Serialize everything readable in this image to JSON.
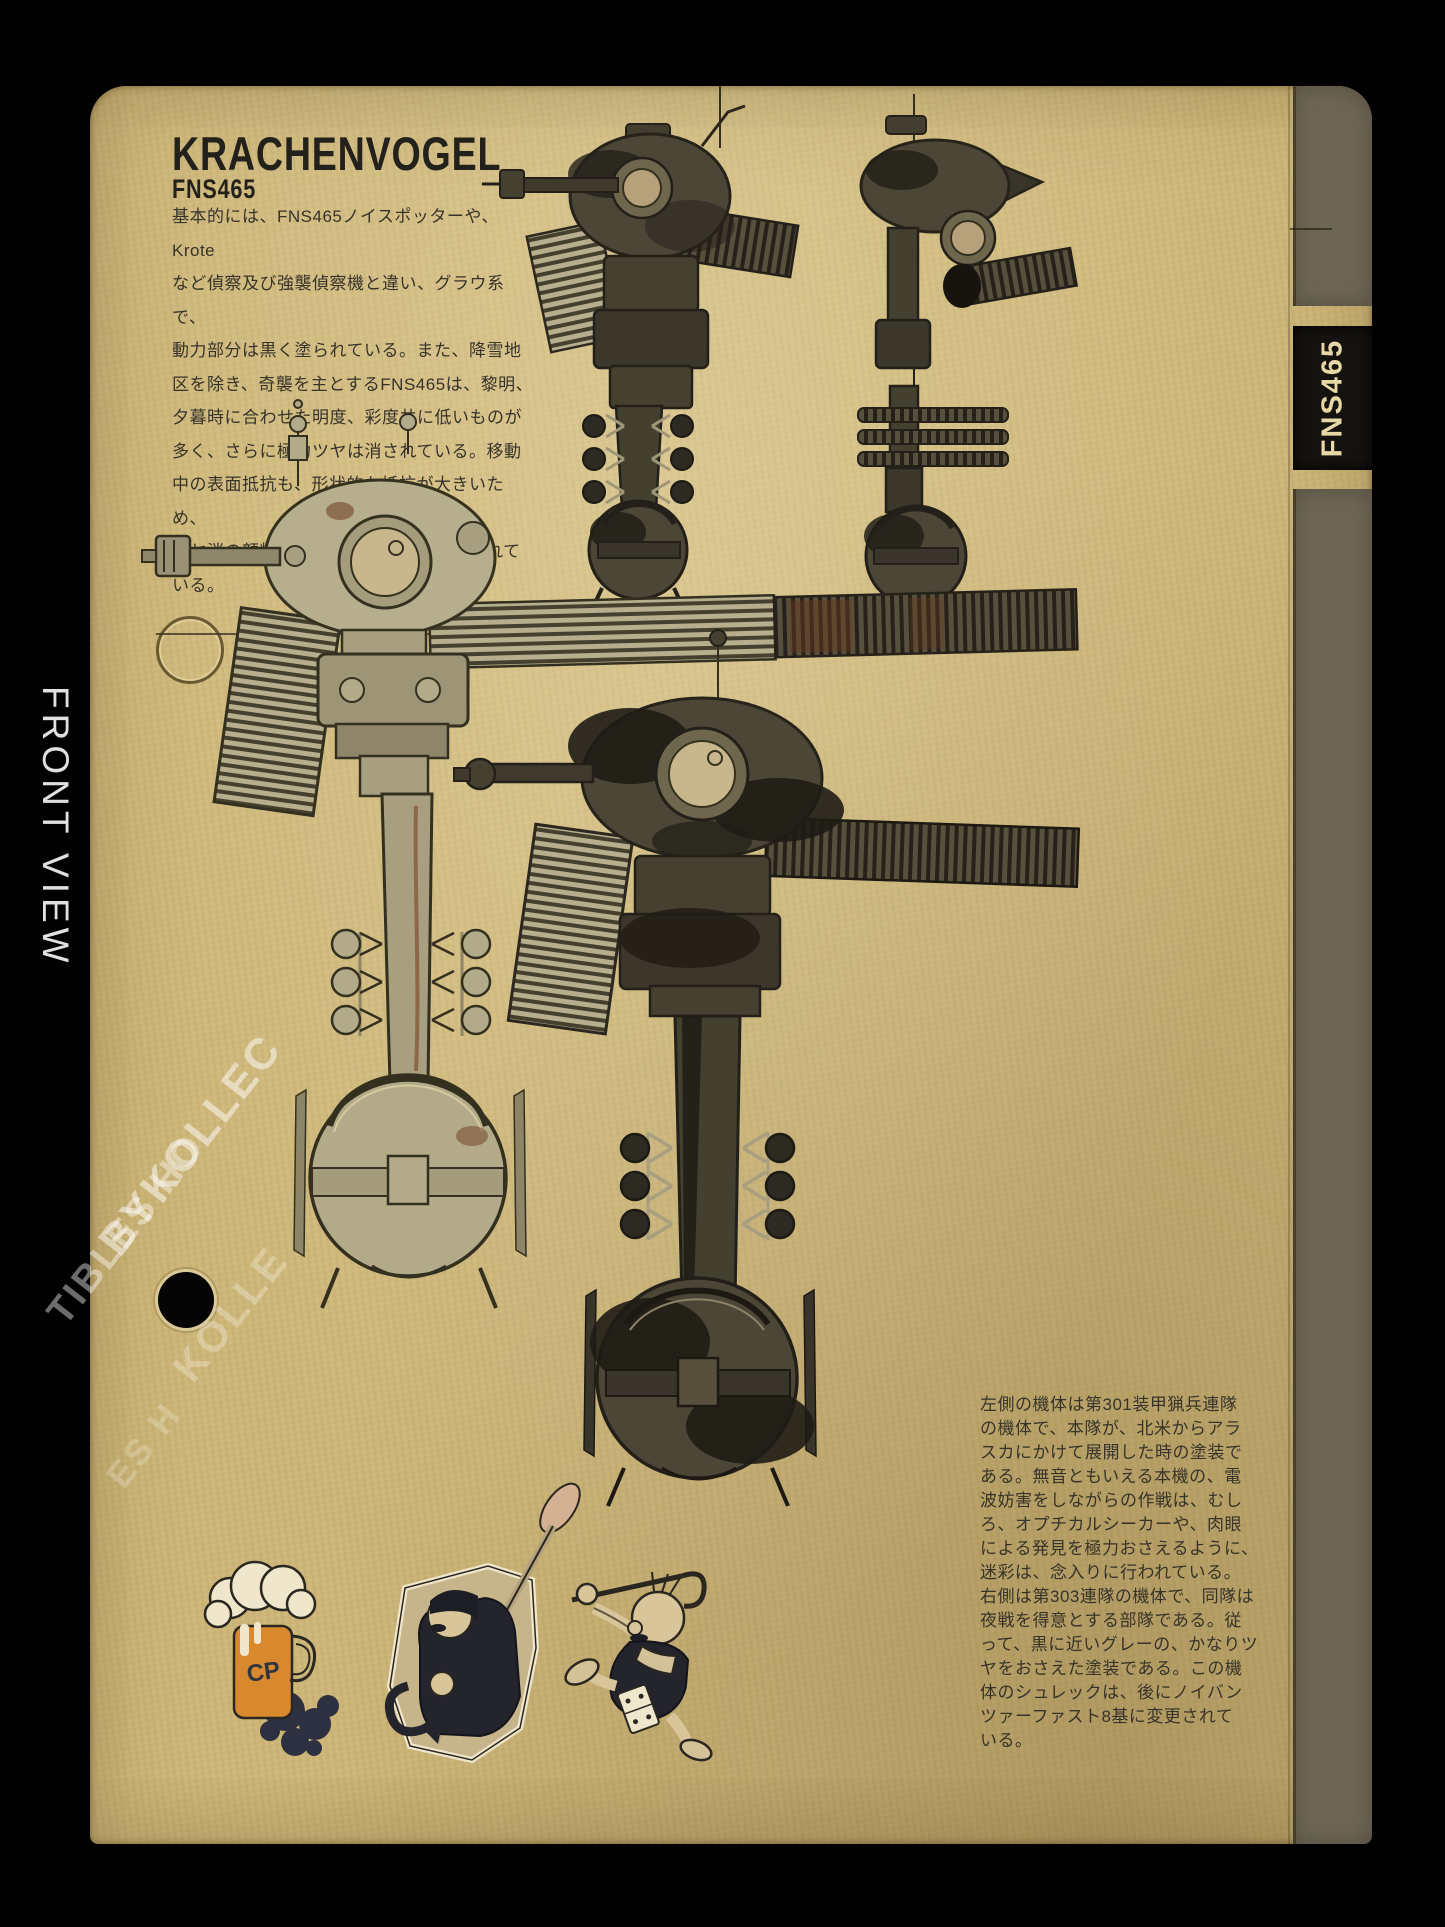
{
  "page": {
    "title": "KRACHENVOGEL",
    "subtitle": "FNS465",
    "intro_text": "基本的には、FNS465ノイスポッターや、Krote\nなど偵察及び強襲偵察機と違い、グラウ系で、\n動力部分は黒く塗られている。また、降雪地\n区を除き、奇襲を主とするFNS465は、黎明、\n夕暮時に合わせた明度、彩度共に低いものが\n多く、さらに極力ツヤは消されている。移動\n中の表面抵抗も、形状的な抵抗が大きいため、\nツヤ消の顔料は、かなり荒いものも使われて\nいる。",
    "caption_text": "左側の機体は第301装甲猟兵連隊\nの機体で、本隊が、北米からアラ\nスカにかけて展開した時の塗装で\nある。無音ともいえる本機の、電\n波妨害をしながらの作戦は、むし\nろ、オプチカルシーカーや、肉眼\nによる発見を極力おさえるように、\n迷彩は、念入りに行われている。\n右側は第303連隊の機体で、同隊は\n夜戦を得意とする部隊である。従\nって、黒に近いグレーの、かなりツ\nヤをおさえた塗装である。この機\n体のシュレックは、後にノイバン\nツァーファスト8基に変更されて\nいる。",
    "tab_label": "FNS465",
    "mug_label": "CP"
  },
  "margin": {
    "front_view_label": "FRONT VIEW"
  },
  "watermark": {
    "fragments": [
      "BYKOLLEC",
      "TIBLES HO",
      "KOLLE",
      "ES H"
    ]
  },
  "colors": {
    "paper": "#cdb678",
    "ink": "#36332a",
    "title_ink": "#23211b",
    "tab_background": "#151310",
    "tab_text": "#e7d8a5",
    "strip_olive": "#6e6654",
    "mech_light": "#b3aa8a",
    "mech_dark": "#4c4636",
    "camo_black": "#211e16",
    "rust": "#6d3a1f",
    "mug_orange": "#d8892e",
    "splash_navy": "#2d3040"
  }
}
